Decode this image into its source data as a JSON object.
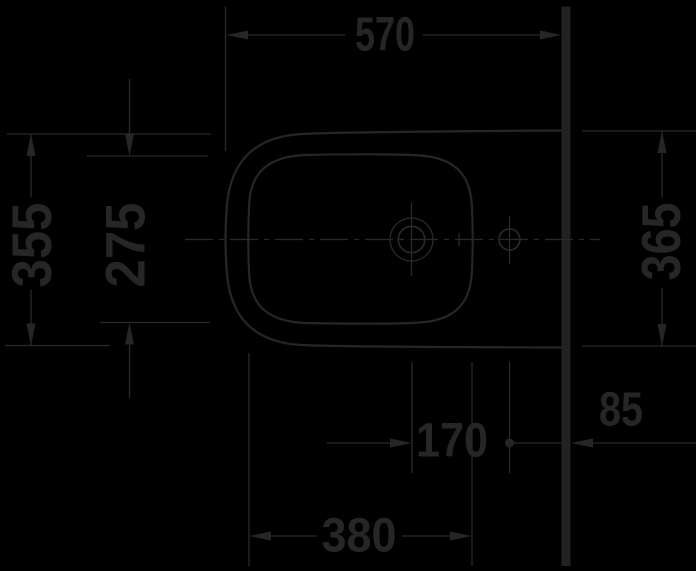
{
  "drawing": {
    "kind": "technical-dimension-drawing",
    "view": "plan-view-sanitary-fixture",
    "units": "mm",
    "dimensions": {
      "overall_depth": "570",
      "overall_width_front": "355",
      "basin_inner_width": "275",
      "overall_width_at_wall": "365",
      "drain_to_supply_hole": "170",
      "supply_hole_to_wall": "85",
      "basin_inner_length": "380"
    },
    "colors": {
      "background": "#000000",
      "line": "#2b2a28",
      "text": "#262624",
      "wall": "#232220"
    }
  }
}
